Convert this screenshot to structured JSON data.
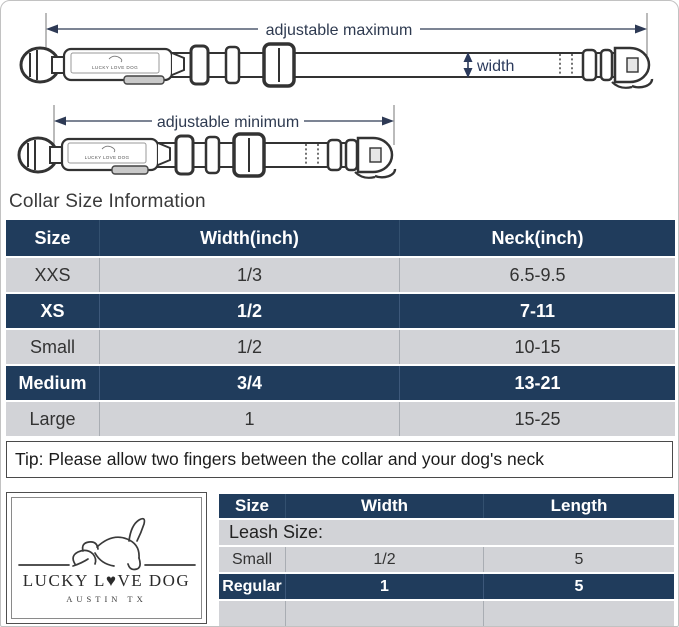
{
  "diagram": {
    "max_label": "adjustable maximum",
    "min_label": "adjustable minimum",
    "width_label": "width",
    "buckle_label": "LUCKY LOVE DOG"
  },
  "collar_section": {
    "title": "Collar Size Information",
    "table": {
      "headers": [
        "Size",
        "Width(inch)",
        "Neck(inch)"
      ],
      "rows": [
        {
          "size": "XXS",
          "width": "1/3",
          "neck": "6.5-9.5"
        },
        {
          "size": "XS",
          "width": "1/2",
          "neck": "7-11"
        },
        {
          "size": "Small",
          "width": "1/2",
          "neck": "10-15"
        },
        {
          "size": "Medium",
          "width": "3/4",
          "neck": "13-21"
        },
        {
          "size": "Large",
          "width": "1",
          "neck": "15-25"
        }
      ]
    },
    "tip": "Tip: Please allow two fingers between the collar and your dog's neck"
  },
  "brand": {
    "name": "LUCKY L♥VE DOG",
    "location": "AUSTIN TX"
  },
  "leash_section": {
    "title": "Leash Size:",
    "table": {
      "headers": [
        "Size",
        "Width",
        "Length"
      ],
      "rows": [
        {
          "size": "Small",
          "width": "1/2",
          "length": "5"
        },
        {
          "size": "Regular",
          "width": "1",
          "length": "5"
        }
      ]
    }
  },
  "colors": {
    "header_navy": "#203c5c",
    "row_gray": "#d2d3d7",
    "dimension_arrow": "#2e3a55"
  }
}
